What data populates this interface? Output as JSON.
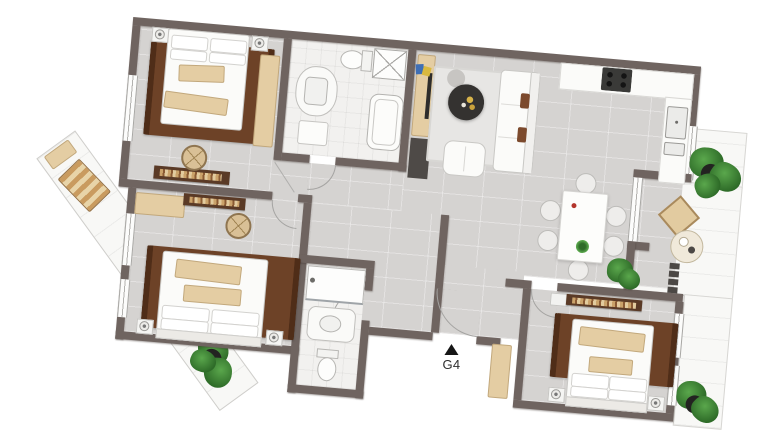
{
  "entrance": {
    "label": "G4",
    "marker_icon": "triangle-up"
  },
  "colors": {
    "wall": "#6f6460",
    "floor": "#d5d3d1",
    "bathFloor": "#f2f1ef",
    "balconyFloor": "#f8f8f6",
    "rug": "#6d4227",
    "rugEdge": "#4f2d18",
    "wood": "#e4cda3",
    "woodDark": "#5a3a26",
    "furnWhite": "#fbfbf9",
    "outline": "#c9c8c5",
    "pillowBrown": "#7c4a2d",
    "tableDark": "#343230",
    "plant": "#3f8136",
    "pot": "#232321",
    "stove": "#3a3a38",
    "accentRed": "#b3352c",
    "accentBlue": "#3f6fb5",
    "accentYellow": "#d9b93f",
    "text": "#2f2f2f"
  }
}
